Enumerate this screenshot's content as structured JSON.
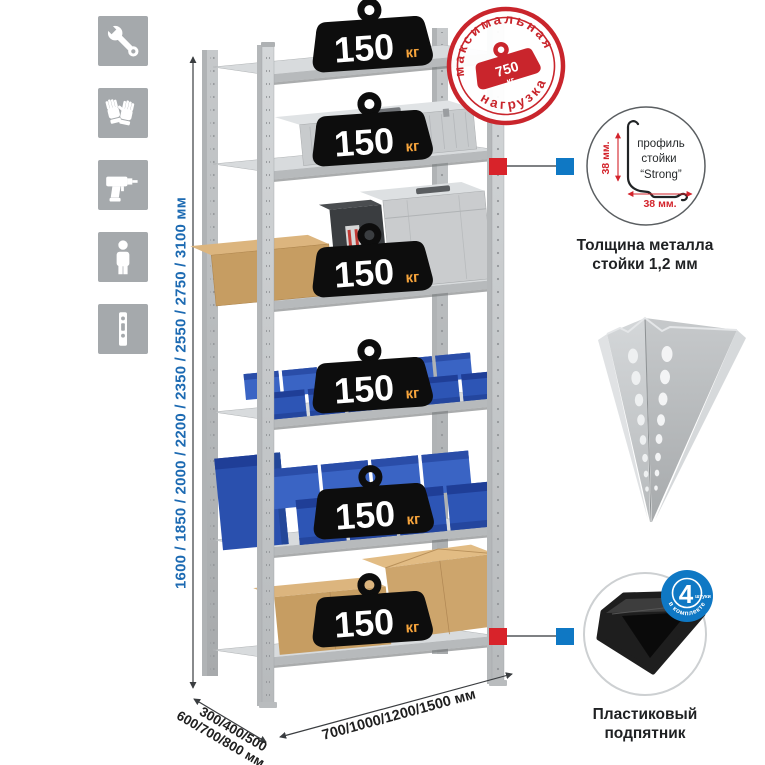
{
  "left_toolbar": {
    "icons": [
      {
        "name": "wrench"
      },
      {
        "name": "gloves"
      },
      {
        "name": "drill"
      },
      {
        "name": "person"
      },
      {
        "name": "perforated-profile"
      }
    ]
  },
  "height_dimension": {
    "label": "1600 / 1850 / 2000 / 2200 / 2350 / 2550 / 2750 / 3100 мм",
    "color": "#1c6ab2"
  },
  "depth_dimension": {
    "line1": "300/400/500",
    "line2": "600/700/800 мм"
  },
  "width_dimension": {
    "label": "700/1000/1200/1500 мм"
  },
  "shelf_load_badge": {
    "value": "150",
    "unit": "кг",
    "count": 6
  },
  "max_load_stamp": {
    "arc_top": "максимальная",
    "arc_bottom": "нагрузка",
    "value": "750",
    "unit": "кг",
    "color": "#c9252c"
  },
  "profile_detail": {
    "label_line1": "профиль",
    "label_line2": "стойки",
    "label_line3": "“Strong”",
    "dim_vertical": "38 мм.",
    "dim_horizontal": "38 мм.",
    "caption_line1": "Толщина металла",
    "caption_line2": "стойки 1,2 мм"
  },
  "foot_detail": {
    "badge_count": "4",
    "badge_small": "штуки",
    "badge_arc": "в комплекте",
    "caption_line1": "Пластиковый",
    "caption_line2": "подпятник"
  },
  "colors": {
    "accent_blue": "#0f78c4",
    "marker_red": "#d8232a",
    "stamp_red": "#c9252c",
    "bin_blue": "#2d55b5",
    "dim_text_blue": "#1c6ab2"
  }
}
